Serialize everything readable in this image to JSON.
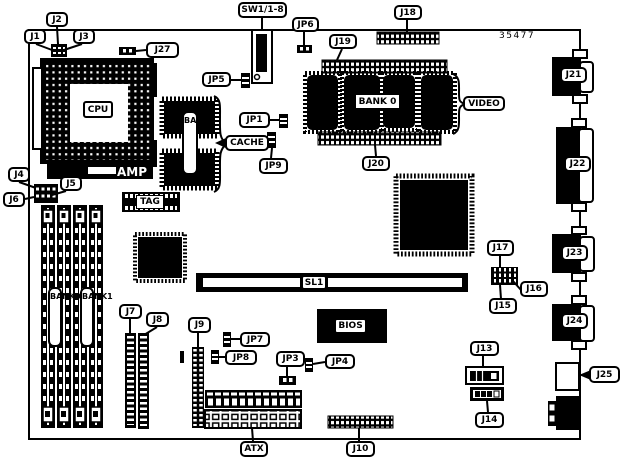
{
  "diagram": {
    "part_number": "35477",
    "callouts": {
      "j1": "J1",
      "j2": "J2",
      "j3": "J3",
      "j4": "J4",
      "j5": "J5",
      "j6": "J6",
      "j7": "J7",
      "j8": "J8",
      "j9": "J9",
      "j10": "J10",
      "j13": "J13",
      "j14": "J14",
      "j15": "J15",
      "j16": "J16",
      "j17": "J17",
      "j18": "J18",
      "j19": "J19",
      "j20": "J20",
      "j21": "J21",
      "j22": "J22",
      "j23": "J23",
      "j24": "J24",
      "j25": "J25",
      "j27": "J27",
      "jp1": "JP1",
      "jp3": "JP3",
      "jp4": "JP4",
      "jp5": "JP5",
      "jp6": "JP6",
      "jp7": "JP7",
      "jp8": "JP8",
      "jp9": "JP9",
      "sw1": "SW1/1-8",
      "cache": "CACHE",
      "video": "VIDEO",
      "atx": "ATX"
    },
    "chip_labels": {
      "cpu": "CPU",
      "amp": "AMP",
      "tag": "TAG",
      "sl1": "SL1",
      "bios": "BIOS",
      "video_bank": "BANK 0",
      "cache_bank": "BANK0",
      "mem_bank0": "BANK0",
      "mem_bank1": "BANK1"
    }
  }
}
